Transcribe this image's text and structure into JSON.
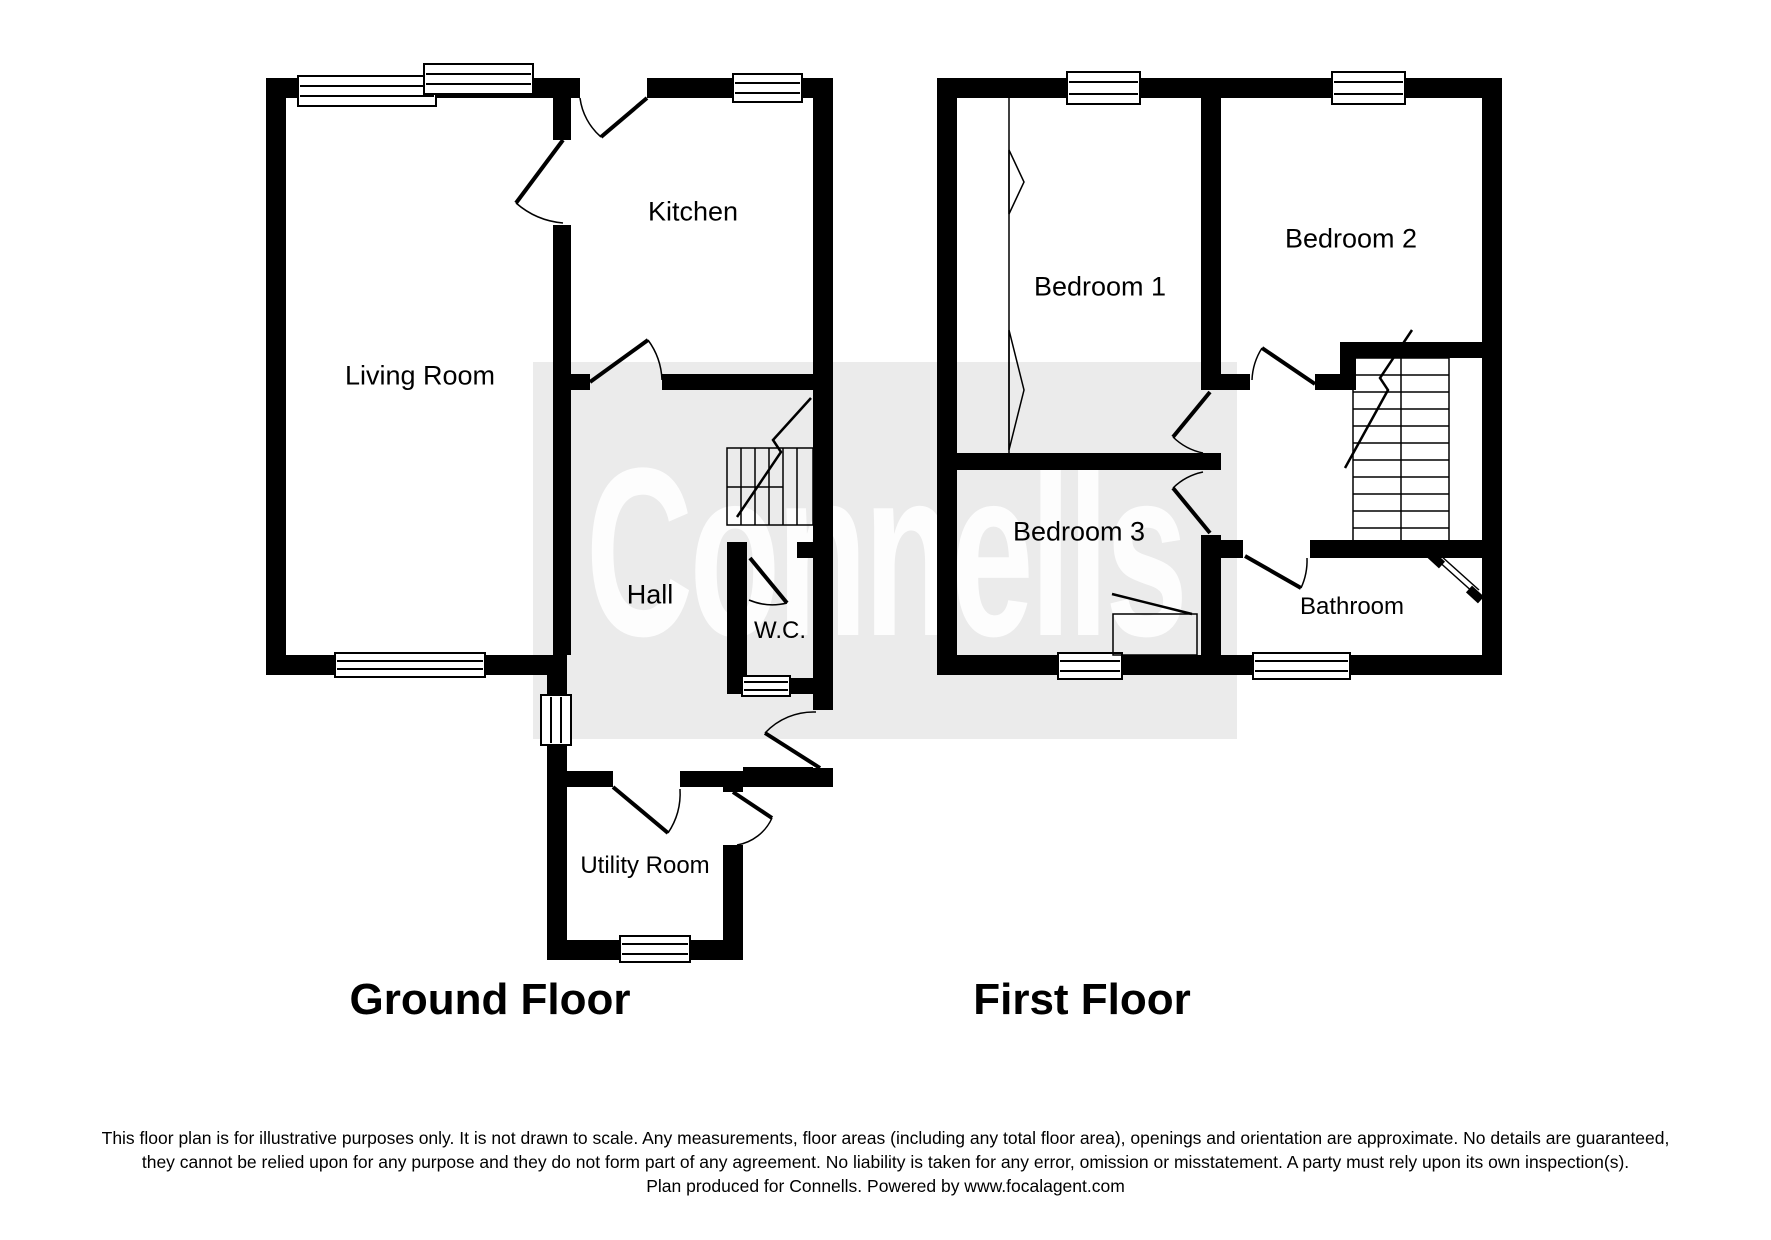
{
  "watermark": {
    "text": "Connells"
  },
  "ground_floor": {
    "title": "Ground Floor",
    "rooms": {
      "living_room": "Living Room",
      "kitchen": "Kitchen",
      "hall": "Hall",
      "wc": "W.C.",
      "utility_room": "Utility Room"
    }
  },
  "first_floor": {
    "title": "First Floor",
    "rooms": {
      "bedroom1": "Bedroom 1",
      "bedroom2": "Bedroom 2",
      "bedroom3": "Bedroom 3",
      "bathroom": "Bathroom"
    }
  },
  "disclaimer": {
    "line1": "This floor plan is for illustrative purposes only. It is not drawn to scale. Any measurements, floor areas (including any total floor area), openings and orientation are approximate. No details are guaranteed,",
    "line2": "they cannot be relied upon for any purpose and they do not form part of any agreement. No liability is taken for any error, omission or misstatement. A party must rely upon its own inspection(s).",
    "line3": "Plan produced for Connells. Powered by www.focalagent.com"
  },
  "colors": {
    "wall": "#000000",
    "background": "#ffffff",
    "watermark_band": "#ebebeb",
    "watermark_text": "#f8f8f8"
  }
}
